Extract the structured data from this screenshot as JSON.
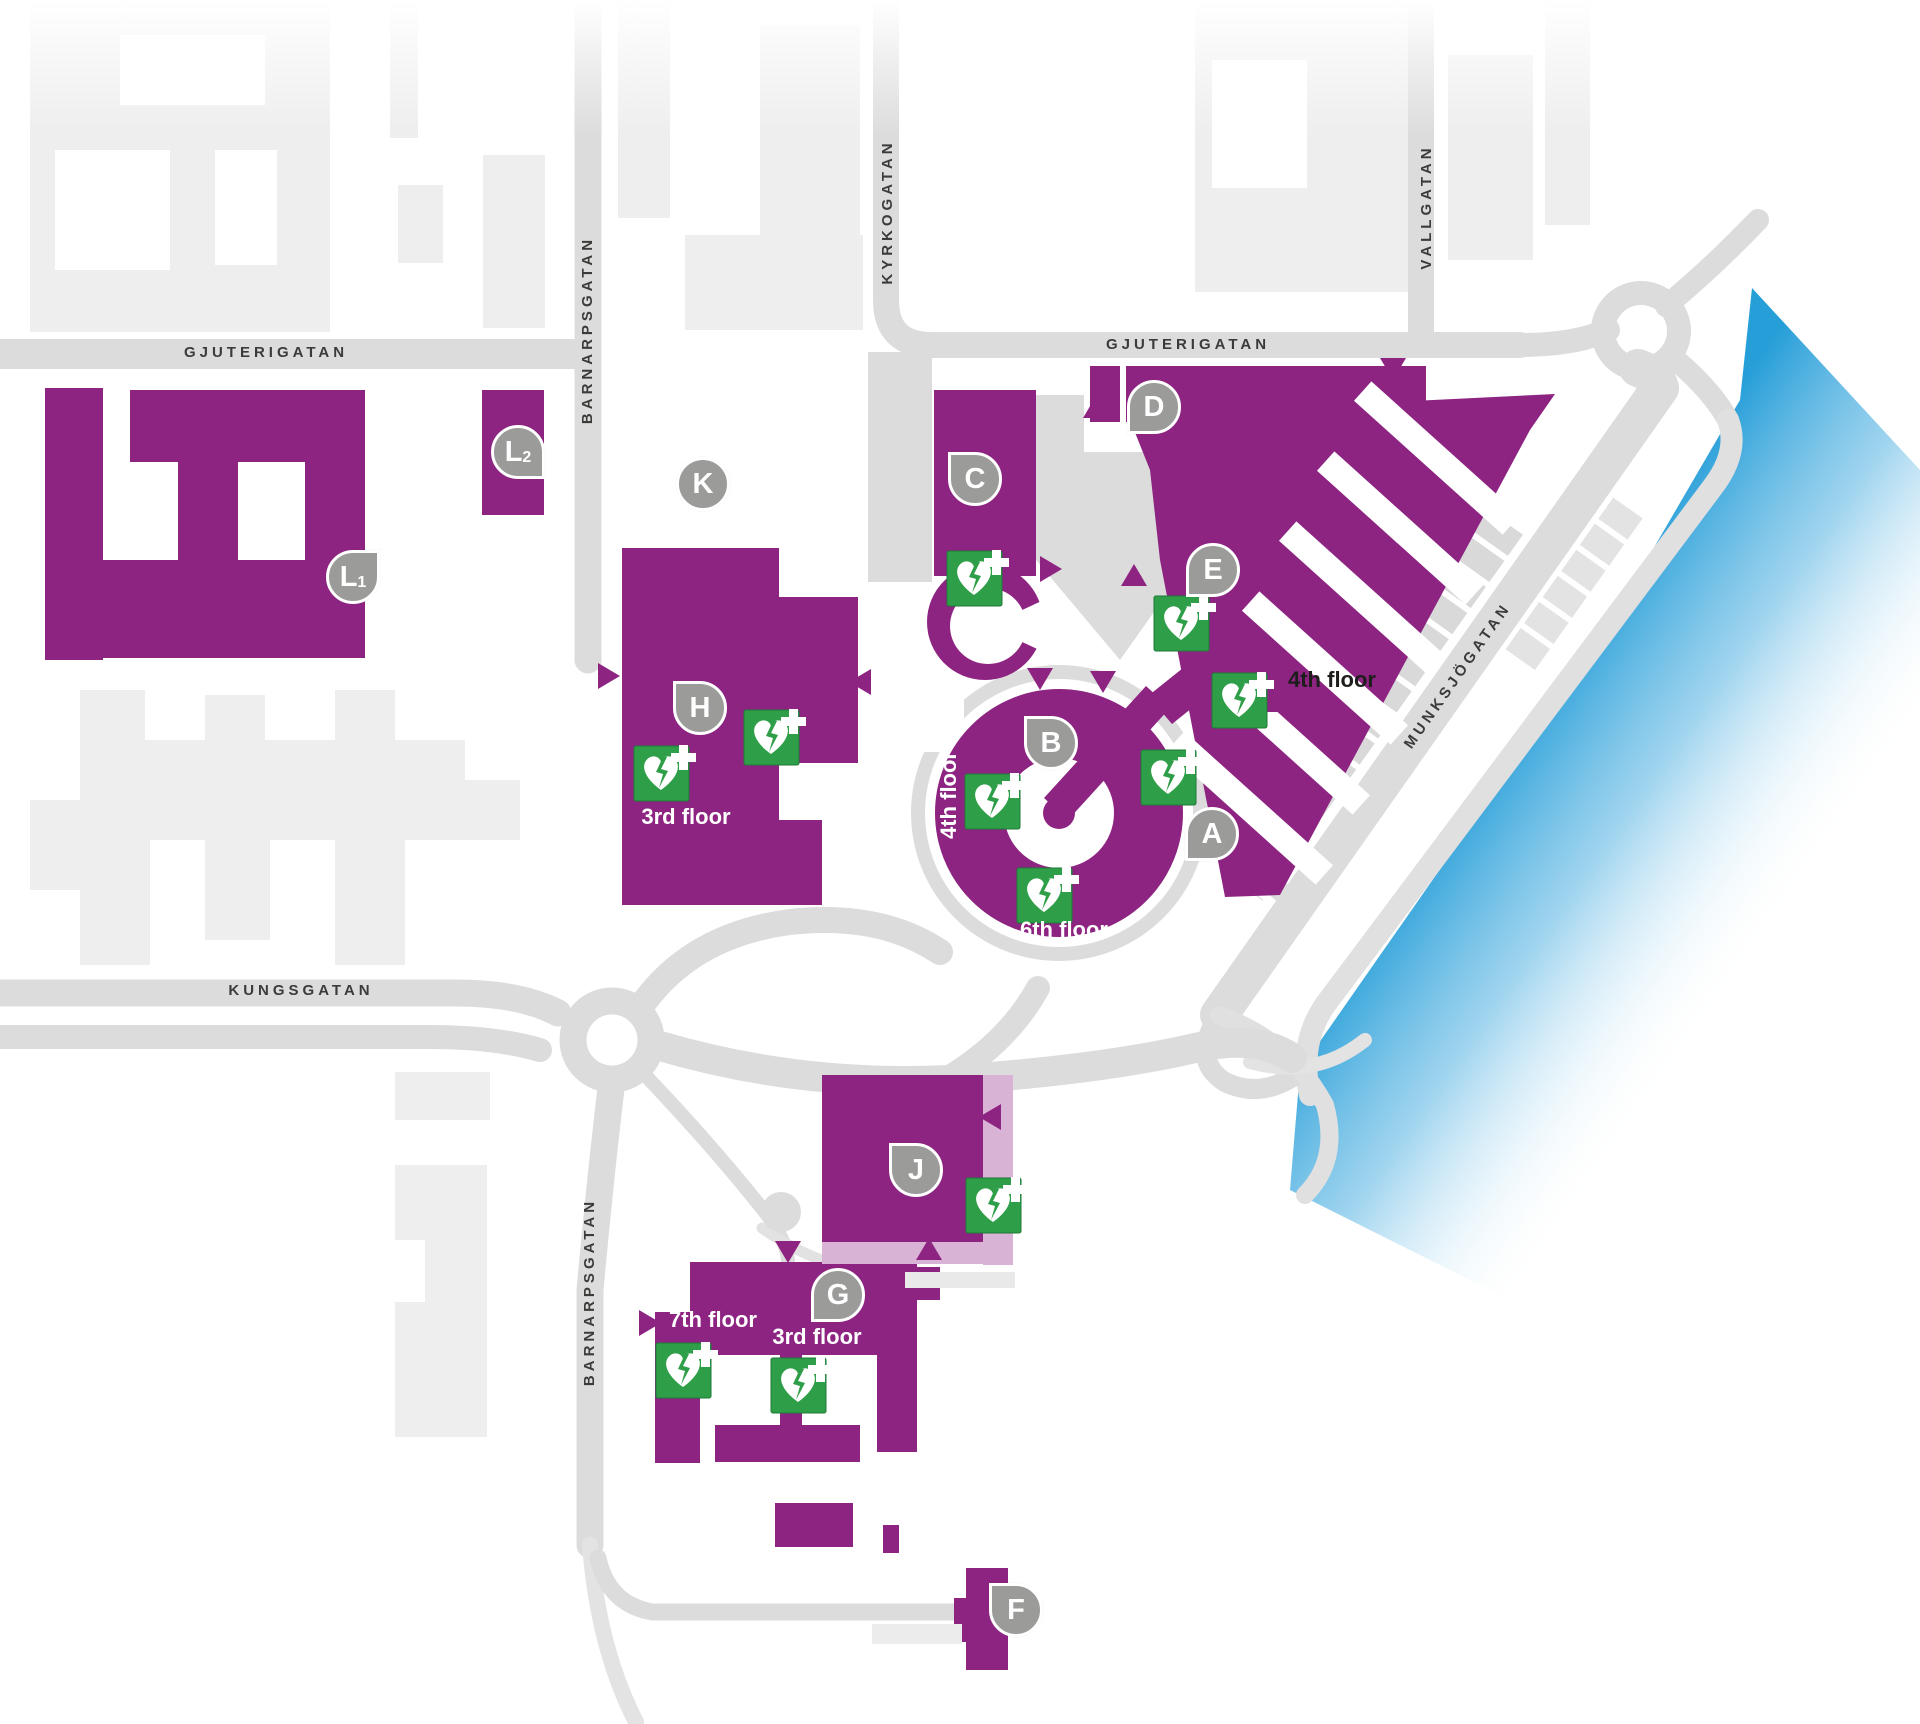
{
  "streets": {
    "gjuterigatan": "GJUTERIGATAN",
    "barnarpsgatan": "BARNARPSGATAN",
    "kyrkogatan": "KYRKOGATAN",
    "vallgatan": "VALLGATAN",
    "munksjogatan": "MUNKSJÖGATAN",
    "kungsgatan": "KUNGSGATAN"
  },
  "badges": {
    "a": "A",
    "b": "B",
    "c": "C",
    "d": "D",
    "e": "E",
    "f": "F",
    "g": "G",
    "h": "H",
    "j": "J",
    "k": "K",
    "l": "L",
    "l1_sub": "1",
    "l2_sub": "2"
  },
  "floor_labels": {
    "floor_3": "3rd floor",
    "floor_4": "4th floor",
    "floor_6": "6th floor",
    "floor_7": "7th floor"
  },
  "icons": {
    "aed": "aed-defibrillator-icon"
  },
  "colors": {
    "building_purple": "#8e2482",
    "walkway_light_purple": "#d9b3d5",
    "road_gray": "#dcdcdc",
    "light_building_gray": "#eeeeee",
    "badge_gray": "#9b9b9a",
    "aed_green": "#2f9e48",
    "water_blue": "#1f9bd7",
    "street_text": "#3b3b3a"
  }
}
